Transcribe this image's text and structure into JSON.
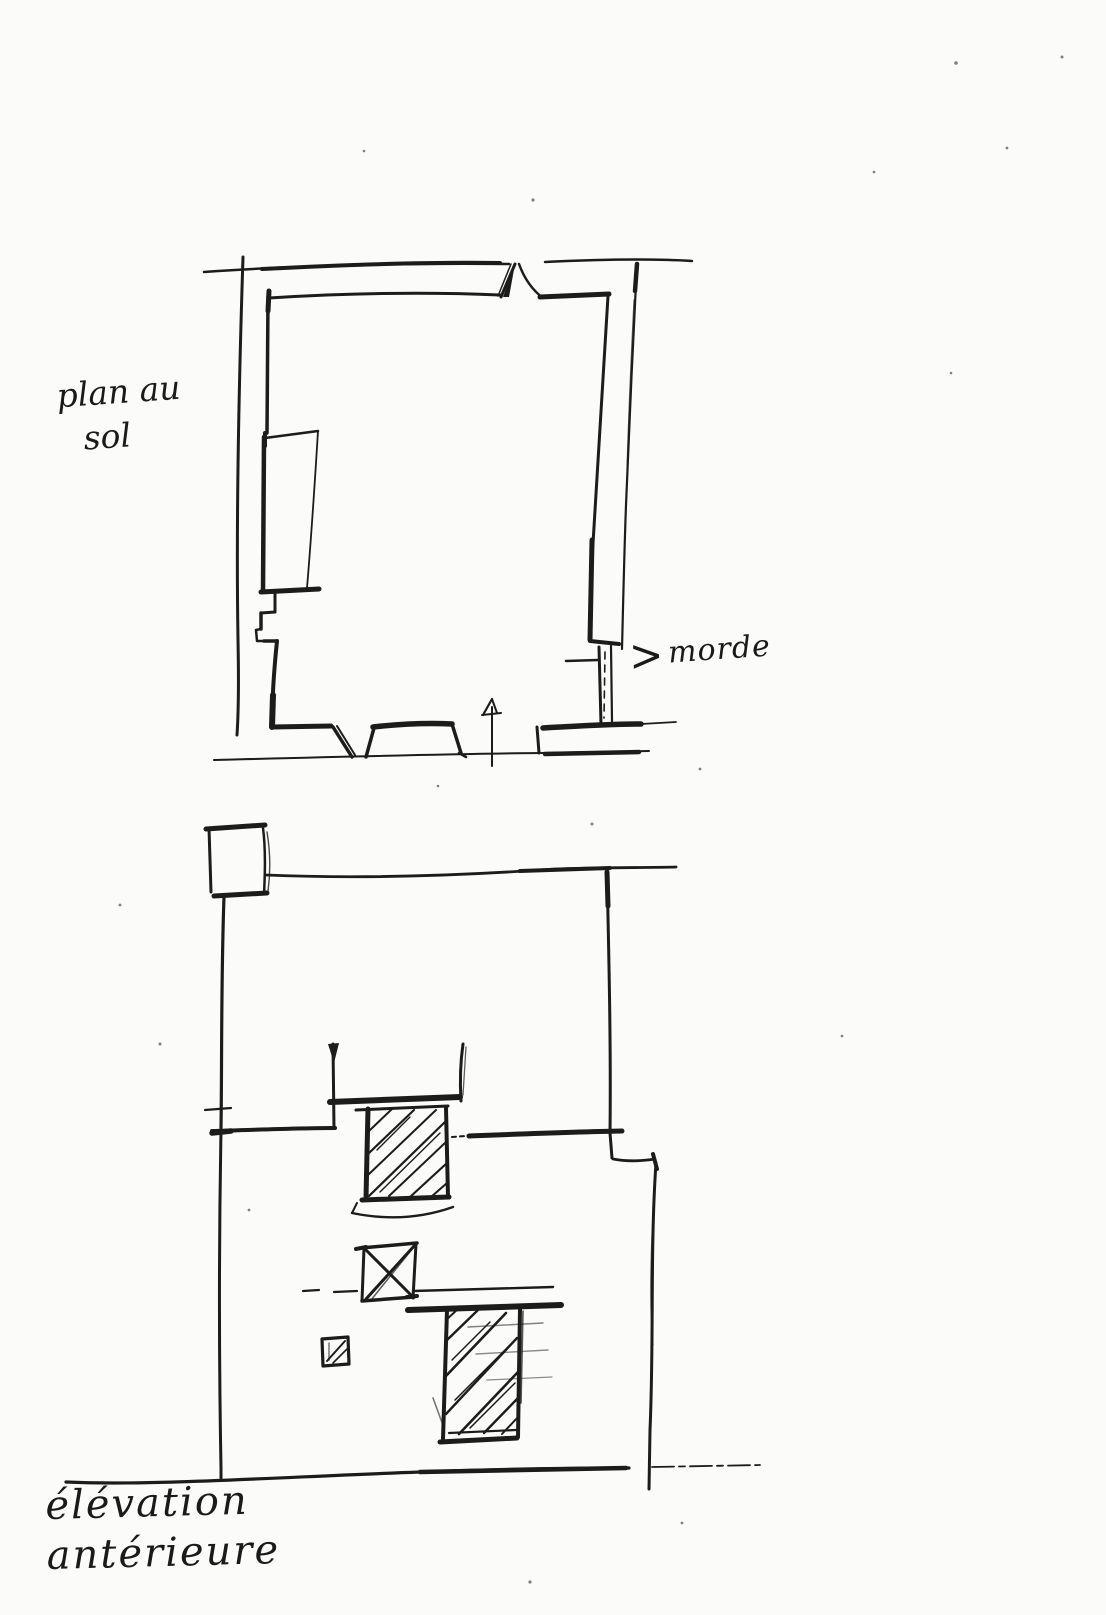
{
  "page": {
    "paper_color": "#fbfbf9",
    "ink_color": "#1c1c1c"
  },
  "labels": {
    "floor_plan": {
      "line1": "plan au",
      "line2": "sol"
    },
    "wall_annotation": {
      "arrow_glyph": ">",
      "text": "morde"
    },
    "elevation": {
      "line1": "élévation",
      "line2": "antérieure"
    }
  }
}
